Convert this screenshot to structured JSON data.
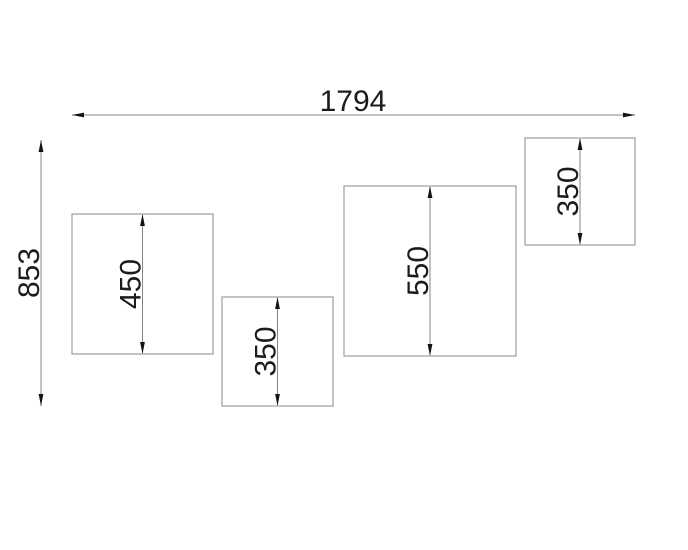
{
  "colors": {
    "background": "#ffffff",
    "outline": "#9c9c9c",
    "dim_line": "#848484",
    "arrow": "#141414",
    "text": "#1c1c1c"
  },
  "drawing": {
    "overall_width": {
      "label": "1794",
      "value": 1794
    },
    "overall_height": {
      "label": "853",
      "value": 853
    },
    "panels": [
      {
        "id": "panel-1",
        "height_label": "450",
        "height": 450
      },
      {
        "id": "panel-2",
        "height_label": "350",
        "height": 350
      },
      {
        "id": "panel-3",
        "height_label": "550",
        "height": 550
      },
      {
        "id": "panel-4",
        "height_label": "350",
        "height": 350
      }
    ]
  }
}
